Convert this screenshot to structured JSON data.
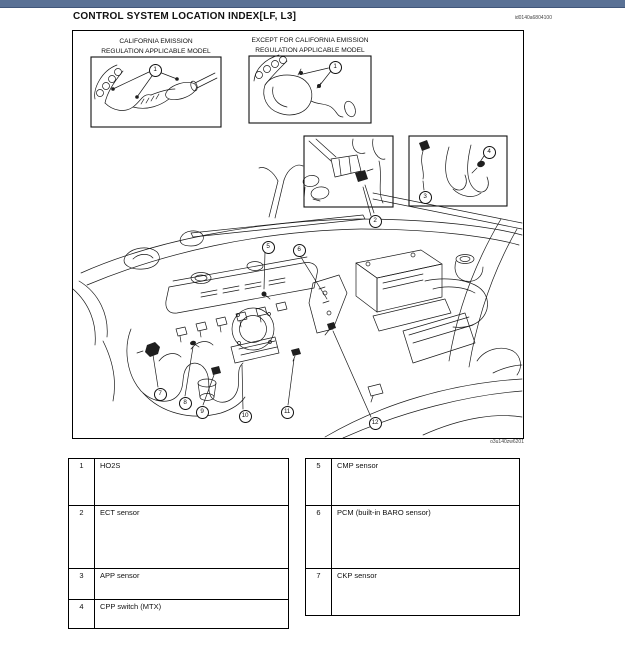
{
  "header": {
    "title": "CONTROL SYSTEM LOCATION INDEX[LF, L3]",
    "doc_code": "id0140a6804100"
  },
  "figure": {
    "art_code": "o3u140zw6201",
    "insets": [
      {
        "label_line1": "CALIFORNIA EMISSION",
        "label_line2": "REGULATION APPLICABLE MODEL"
      },
      {
        "label_line1": "EXCEPT FOR CALIFORNIA EMISSION",
        "label_line2": "REGULATION APPLICABLE MODEL"
      }
    ],
    "callouts": [
      "1",
      "1",
      "2",
      "3",
      "4",
      "5",
      "6",
      "7",
      "8",
      "9",
      "10",
      "11",
      "12"
    ]
  },
  "tables": {
    "left": {
      "rows": [
        {
          "num": "1",
          "label": "HO2S"
        },
        {
          "num": "2",
          "label": "ECT sensor"
        },
        {
          "num": "3",
          "label": "APP sensor"
        },
        {
          "num": "4",
          "label": "CPP switch (MTX)"
        }
      ]
    },
    "right": {
      "rows": [
        {
          "num": "5",
          "label": "CMP sensor"
        },
        {
          "num": "6",
          "label": "PCM (built-in BARO sensor)"
        },
        {
          "num": "7",
          "label": "CKP sensor"
        }
      ]
    }
  }
}
